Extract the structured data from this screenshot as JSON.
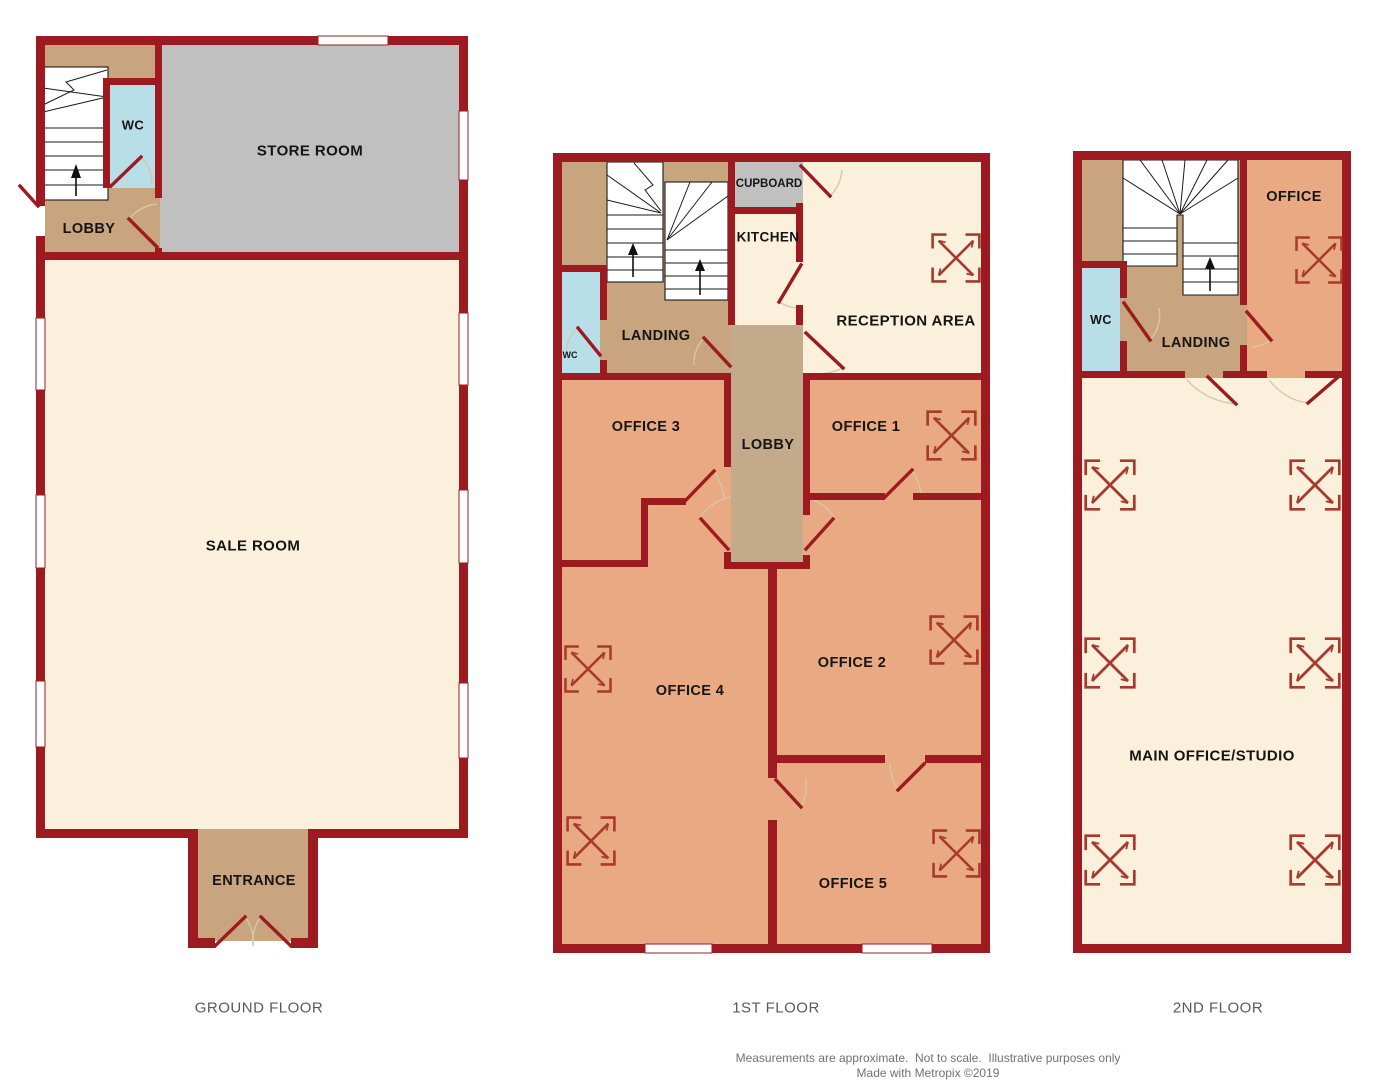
{
  "floors": {
    "ground": {
      "label": "GROUND FLOOR",
      "rooms": {
        "wc": "WC",
        "store": "STORE ROOM",
        "lobby": "LOBBY",
        "sale": "SALE ROOM",
        "entrance": "ENTRANCE"
      }
    },
    "first": {
      "label": "1ST FLOOR",
      "rooms": {
        "cupboard": "CUPBOARD",
        "kitchen": "KITCHEN",
        "reception": "RECEPTION AREA",
        "landing": "LANDING",
        "wc": "WC",
        "office3": "OFFICE 3",
        "lobby": "LOBBY",
        "office1": "OFFICE 1",
        "office4": "OFFICE 4",
        "office2": "OFFICE 2",
        "office5": "OFFICE 5"
      }
    },
    "second": {
      "label": "2ND FLOOR",
      "rooms": {
        "office": "OFFICE",
        "wc": "WC",
        "landing": "LANDING",
        "main": "MAIN OFFICE/STUDIO"
      }
    }
  },
  "footer": {
    "line1": "Measurements are approximate.  Not to scale.  Illustrative purposes only",
    "line2": "Made with Metropix ©2019"
  },
  "colors": {
    "wall": "#9d1b20",
    "office_salmon": "#e9a982",
    "hall_tan": "#c8a57e",
    "lobby_tan": "#c3aa8b",
    "room_cream": "#faf0db",
    "store_gray": "#c1c0c0",
    "wc_blue": "#b8dee8",
    "symbol_red": "#a83a2d",
    "stairs_white": "#ffffff",
    "label_text": "#151515",
    "floor_label_text": "#59595b",
    "footer_text": "#717174"
  }
}
